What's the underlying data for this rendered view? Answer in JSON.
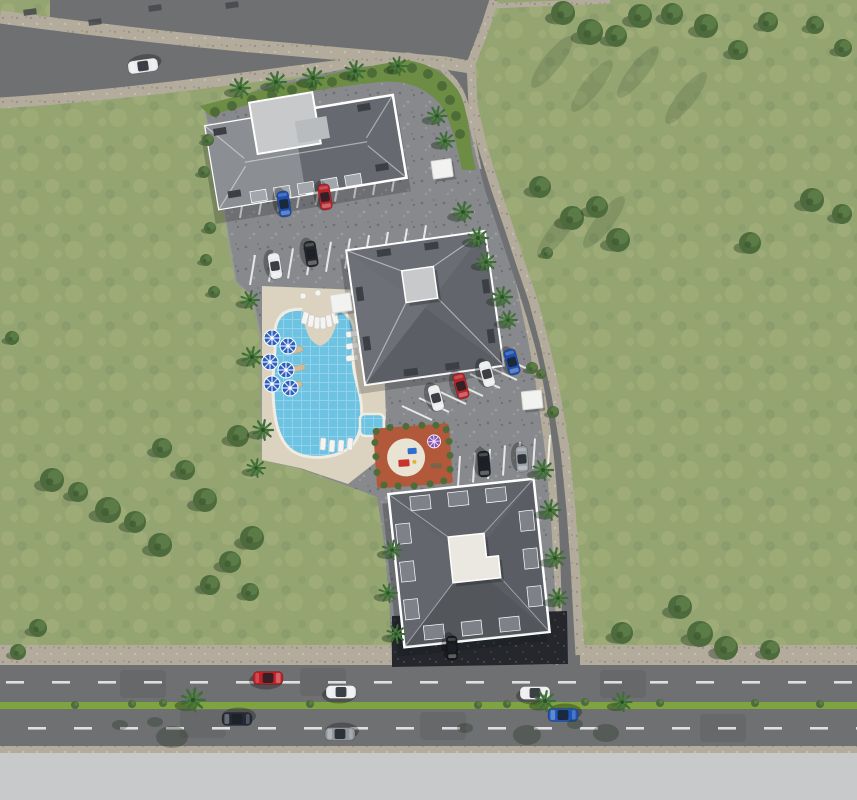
{
  "meta": {
    "description": "Aerial 3D render of a residential site plan: three gray-roofed apartment blocks outlined in white, swimming pool with sun loungers and striped umbrellas, children's playground, parking areas with cars, palm trees, lawns with scattered trees, a curving access road and a palm-lined boulevard at the bottom."
  },
  "palette": {
    "grass": "#95a572",
    "grassLight": "#a9b47f",
    "grassDark": "#839567",
    "lawn": "#6d8c44",
    "hedge": "#4e6c38",
    "bush": "#4d6b3c",
    "bushLight": "#5e7e48",
    "palm": "#3e6d36",
    "road": "#6e7072",
    "gravel": "#b3ab9b",
    "gravelDot": "#9a9284",
    "sidewalk": "#c8c9cb",
    "median": "#7da43e",
    "laneMark": "#f2f3f4",
    "pavement": "#87898c",
    "pavementDark": "#6f7174",
    "pavementLight": "#9b9da0",
    "deck": "#dbd2c0",
    "water": "#6ec2e2",
    "waterLine": "#9ad7ec",
    "poolEdge": "#f0ece2",
    "terracotta": "#b2593c",
    "playCircle": "#e9e3d3",
    "roofLight": "#8b8f94",
    "roofMid": "#666a70",
    "roofMid2": "#62666c",
    "roofDark": "#5a5e64",
    "roofCore": "#c7c9ca",
    "coreWhite": "#eae8e1",
    "vent": "#3c3f44",
    "outline": "#ffffff",
    "darkStrip": "#25272c",
    "white": "#f2f2f0"
  },
  "cars": [
    {
      "n": "car-top-road-white",
      "c": "#e9ebed",
      "x": 143,
      "y": 66,
      "r": 172,
      "l": 30,
      "w": 13
    },
    {
      "n": "car-p1-blue",
      "c": "#1f4fae",
      "x": 284,
      "y": 204,
      "r": 81,
      "l": 26,
      "w": 12
    },
    {
      "n": "car-p1-red",
      "c": "#b6242a",
      "x": 325,
      "y": 197,
      "r": 81,
      "l": 26,
      "w": 12
    },
    {
      "n": "car-p1-white",
      "c": "#e9ebed",
      "x": 275,
      "y": 266,
      "r": 81,
      "l": 26,
      "w": 12
    },
    {
      "n": "car-p1-black",
      "c": "#23262b",
      "x": 311,
      "y": 254,
      "r": 81,
      "l": 26,
      "w": 12
    },
    {
      "n": "car-p2-white-1",
      "c": "#e9ebed",
      "x": 436,
      "y": 398,
      "r": 75,
      "l": 26,
      "w": 12
    },
    {
      "n": "car-p2-red",
      "c": "#b6242a",
      "x": 461,
      "y": 386,
      "r": 75,
      "l": 26,
      "w": 12
    },
    {
      "n": "car-p2-white-2",
      "c": "#e9ebed",
      "x": 487,
      "y": 374,
      "r": 75,
      "l": 26,
      "w": 12
    },
    {
      "n": "car-p2-blue",
      "c": "#1f4fae",
      "x": 512,
      "y": 362,
      "r": 75,
      "l": 26,
      "w": 12
    },
    {
      "n": "car-p3-black",
      "c": "#1d2024",
      "x": 484,
      "y": 464,
      "r": 86,
      "l": 26,
      "w": 12
    },
    {
      "n": "car-p3-gray",
      "c": "#9aa0a5",
      "x": 522,
      "y": 459,
      "r": 86,
      "l": 26,
      "w": 12
    },
    {
      "n": "car-garage-black",
      "c": "#17181b",
      "x": 452,
      "y": 648,
      "r": 88,
      "l": 24,
      "w": 11
    },
    {
      "n": "car-road-red",
      "c": "#c01f26",
      "x": 268,
      "y": 678,
      "r": 0,
      "l": 30,
      "w": 13
    },
    {
      "n": "car-road-white-1",
      "c": "#eceef0",
      "x": 341,
      "y": 692,
      "r": 0,
      "l": 30,
      "w": 13
    },
    {
      "n": "car-road-white-2",
      "c": "#eceef0",
      "x": 535,
      "y": 693,
      "r": 0,
      "l": 30,
      "w": 13
    },
    {
      "n": "car-road-navy",
      "c": "#252a36",
      "x": 237,
      "y": 719,
      "r": 180,
      "l": 30,
      "w": 13
    },
    {
      "n": "car-road-blue",
      "c": "#1c55b8",
      "x": 563,
      "y": 715,
      "r": 180,
      "l": 30,
      "w": 13
    },
    {
      "n": "car-road-gray",
      "c": "#8f959b",
      "x": 340,
      "y": 734,
      "r": 180,
      "l": 30,
      "w": 13
    }
  ],
  "palms": [
    [
      240,
      88,
      1
    ],
    [
      276,
      82,
      1
    ],
    [
      313,
      78,
      1.05
    ],
    [
      355,
      71,
      1
    ],
    [
      398,
      66,
      0.9
    ],
    [
      437,
      116,
      0.95
    ],
    [
      445,
      141,
      0.9
    ],
    [
      250,
      300,
      0.9
    ],
    [
      252,
      357,
      1
    ],
    [
      263,
      430,
      1
    ],
    [
      256,
      468,
      0.9
    ],
    [
      463,
      212,
      1
    ],
    [
      478,
      238,
      1
    ],
    [
      486,
      262,
      0.95
    ],
    [
      502,
      297,
      1
    ],
    [
      508,
      320,
      0.9
    ],
    [
      543,
      470,
      1
    ],
    [
      550,
      510,
      1
    ],
    [
      555,
      558,
      1
    ],
    [
      558,
      598,
      0.95
    ],
    [
      392,
      550,
      0.95
    ],
    [
      388,
      593,
      0.9
    ],
    [
      396,
      634,
      0.9
    ],
    [
      193,
      700,
      1.15
    ],
    [
      545,
      701,
      1
    ],
    [
      622,
      702,
      0.95
    ]
  ],
  "bushes": [
    [
      52,
      480,
      12
    ],
    [
      78,
      492,
      10
    ],
    [
      108,
      510,
      13
    ],
    [
      135,
      522,
      11
    ],
    [
      160,
      545,
      12
    ],
    [
      185,
      470,
      10
    ],
    [
      205,
      500,
      12
    ],
    [
      230,
      562,
      11
    ],
    [
      252,
      538,
      12
    ],
    [
      162,
      448,
      10
    ],
    [
      238,
      436,
      11
    ],
    [
      210,
      585,
      10
    ],
    [
      250,
      592,
      9
    ],
    [
      38,
      628,
      9
    ],
    [
      18,
      652,
      8
    ],
    [
      12,
      338,
      7
    ],
    [
      563,
      13,
      12
    ],
    [
      590,
      32,
      13
    ],
    [
      616,
      36,
      11
    ],
    [
      640,
      16,
      12
    ],
    [
      672,
      14,
      11
    ],
    [
      706,
      26,
      12
    ],
    [
      738,
      50,
      10
    ],
    [
      768,
      22,
      10
    ],
    [
      815,
      25,
      9
    ],
    [
      843,
      48,
      9
    ],
    [
      540,
      187,
      11
    ],
    [
      572,
      218,
      12
    ],
    [
      597,
      207,
      11
    ],
    [
      618,
      240,
      12
    ],
    [
      750,
      243,
      11
    ],
    [
      812,
      200,
      12
    ],
    [
      842,
      214,
      10
    ],
    [
      622,
      633,
      11
    ],
    [
      680,
      607,
      12
    ],
    [
      700,
      634,
      13
    ],
    [
      726,
      648,
      12
    ],
    [
      770,
      650,
      10
    ],
    [
      208,
      140,
      6
    ],
    [
      204,
      172,
      6
    ],
    [
      210,
      228,
      6
    ],
    [
      206,
      260,
      6
    ],
    [
      214,
      292,
      6
    ],
    [
      547,
      253,
      6
    ],
    [
      532,
      368,
      6
    ],
    [
      541,
      374,
      5
    ],
    [
      553,
      412,
      6
    ]
  ],
  "garden_hedge": [
    [
      215,
      112
    ],
    [
      232,
      106
    ],
    [
      252,
      100
    ],
    [
      272,
      95
    ],
    [
      292,
      90
    ],
    [
      312,
      86
    ],
    [
      332,
      82
    ],
    [
      352,
      77
    ],
    [
      372,
      73
    ],
    [
      392,
      69
    ],
    [
      412,
      68
    ],
    [
      428,
      74
    ],
    [
      442,
      86
    ],
    [
      450,
      100
    ],
    [
      456,
      116
    ],
    [
      460,
      134
    ]
  ],
  "median_plants": [
    [
      75,
      705
    ],
    [
      132,
      704
    ],
    [
      163,
      703
    ],
    [
      310,
      704
    ],
    [
      478,
      705
    ],
    [
      507,
      704
    ],
    [
      585,
      702
    ],
    [
      660,
      703
    ],
    [
      755,
      703
    ],
    [
      820,
      704
    ]
  ],
  "umbrellas": [
    [
      272,
      338
    ],
    [
      288,
      346
    ],
    [
      270,
      362
    ],
    [
      286,
      370
    ],
    [
      272,
      384
    ],
    [
      290,
      388
    ]
  ],
  "loungers_white": [
    [
      305,
      318,
      14
    ],
    [
      311,
      321,
      8
    ],
    [
      317,
      323,
      3
    ],
    [
      323,
      323,
      -3
    ],
    [
      329,
      321,
      -8
    ],
    [
      335,
      318,
      -14
    ],
    [
      352,
      334,
      82
    ],
    [
      352,
      346,
      82
    ],
    [
      352,
      358,
      82
    ],
    [
      364,
      338,
      82
    ],
    [
      364,
      350,
      82
    ],
    [
      323,
      444,
      4
    ],
    [
      332,
      446,
      4
    ],
    [
      341,
      446,
      4
    ],
    [
      350,
      444,
      4
    ]
  ],
  "loungers_tan": [
    [
      297,
      350,
      75
    ],
    [
      299,
      368,
      75
    ],
    [
      296,
      385,
      75
    ]
  ],
  "pool_tables": [
    [
      303,
      296
    ],
    [
      318,
      293
    ]
  ],
  "stripe_rows": [
    {
      "x": 240,
      "y": 218,
      "n": 9,
      "dx": 19,
      "dy": -3.3,
      "vx": 5,
      "vy": -30
    },
    {
      "x": 250,
      "y": 285,
      "n": 10,
      "dx": 19,
      "dy": -3.3,
      "vx": 5,
      "vy": -30
    },
    {
      "x": 432,
      "y": 420,
      "n": 7,
      "dx": 17,
      "dy": -8,
      "vx": -30,
      "vy": -14
    },
    {
      "x": 458,
      "y": 486,
      "n": 7,
      "dx": 15,
      "dy": -3.5,
      "vx": 2,
      "vy": -30
    }
  ],
  "canopies": [
    {
      "x": 441,
      "y": 168,
      "r": -8
    },
    {
      "x": 531,
      "y": 399,
      "r": -6
    },
    {
      "x": 340,
      "y": 302,
      "r": -8
    }
  ],
  "field_shadow_streaks": [
    [
      552,
      62
    ],
    [
      592,
      86
    ],
    [
      638,
      72
    ],
    [
      686,
      98
    ],
    [
      558,
      232
    ],
    [
      604,
      222
    ]
  ],
  "road_shadows": [
    [
      172,
      737,
      16,
      11
    ],
    [
      527,
      735,
      14,
      10
    ],
    [
      606,
      733,
      13,
      9
    ],
    [
      120,
      725,
      8,
      5
    ],
    [
      155,
      722,
      8,
      5
    ],
    [
      465,
      728,
      8,
      5
    ],
    [
      575,
      724,
      8,
      5
    ]
  ],
  "wear_patches": [
    [
      120,
      670
    ],
    [
      300,
      668
    ],
    [
      600,
      670
    ],
    [
      180,
      710
    ],
    [
      420,
      712
    ],
    [
      700,
      714
    ]
  ],
  "curb_marks": [
    [
      30,
      12
    ],
    [
      95,
      22
    ],
    [
      155,
      8
    ],
    [
      232,
      5
    ]
  ],
  "playground_hedge": [
    [
      -34,
      -27
    ],
    [
      -20,
      -30
    ],
    [
      -4,
      -30
    ],
    [
      12,
      -30
    ],
    [
      26,
      -29
    ],
    [
      36,
      -24
    ],
    [
      38,
      -12
    ],
    [
      38,
      2
    ],
    [
      37,
      16
    ],
    [
      30,
      27
    ],
    [
      16,
      29
    ],
    [
      0,
      30
    ],
    [
      -16,
      29
    ],
    [
      -30,
      27
    ],
    [
      -36,
      14
    ],
    [
      -36,
      -2
    ],
    [
      -36,
      -16
    ]
  ],
  "lane_dashes": {
    "row_y": [
      681,
      727
    ],
    "dash_w": 18,
    "dash_h": 2.6,
    "step": 46,
    "offsets": [
      6,
      28
    ]
  }
}
